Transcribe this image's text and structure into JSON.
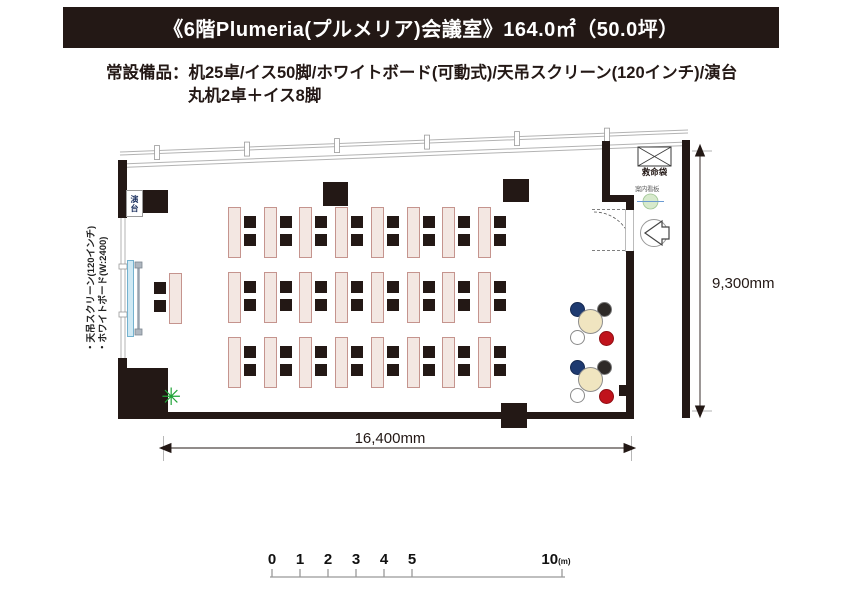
{
  "header": {
    "title": "《6階Plumeria(プルメリア)会議室》164.0㎡（50.0坪）"
  },
  "equipment": {
    "line1": "常設備品：机25卓/イス50脚/ホワイトボード(可動式)/天吊スクリーン(120インチ)/演台",
    "line2": "丸机2卓＋イス8脚"
  },
  "floorplan": {
    "labels": {
      "lectern": "演台",
      "screen_note": "・天吊スクリーン(120インチ)",
      "whiteboard_note": "・ホワイトボード(W:2400)",
      "rescue_bag": "救命袋",
      "info_sign": "案内看板"
    },
    "dimensions": {
      "width": "16,400mm",
      "height": "9,300mm"
    },
    "colors": {
      "wall": "#231815",
      "desk_fill": "#f3e7e2",
      "desk_border": "#c5948e",
      "chair": "#231815",
      "round_table": "#f0e5c0",
      "chair_navy": "#1e3a70",
      "chair_dark": "#2e2a28",
      "chair_white": "#ffffff",
      "chair_red": "#c0131c",
      "screen": "#cfe9f4",
      "plant": "#1fa337"
    },
    "furniture": {
      "desk_rows": {
        "rows_y": [
          207,
          272,
          337
        ],
        "count_per_row": 8,
        "start_x": 228,
        "spacing": 35.7,
        "desk_w": 13,
        "desk_h": 51,
        "chair_dx": 16,
        "chair_dy": [
          9,
          27
        ],
        "chair_size": 12
      },
      "head_desk": {
        "x": 169,
        "y": 273,
        "chair_x": 154,
        "chairs_y": [
          282,
          300
        ]
      },
      "round_tables": {
        "centers": [
          [
            590,
            321
          ],
          [
            590,
            379
          ]
        ],
        "table_r": 12.5,
        "chair_r": 7.5,
        "chair_offsets": {
          "navy": [
            -13,
            -12
          ],
          "dark": [
            14,
            -12
          ],
          "white": [
            -13,
            16
          ],
          "red": [
            16,
            17
          ]
        }
      },
      "pillars": [
        [
          143,
          190,
          25,
          23
        ],
        [
          323,
          182,
          25,
          24
        ],
        [
          503,
          179,
          26,
          23
        ],
        [
          501,
          403,
          26,
          25
        ]
      ],
      "walls": [
        [
          118,
          160,
          9,
          58
        ],
        [
          118,
          358,
          9,
          54
        ],
        [
          118,
          368,
          50,
          44
        ],
        [
          118,
          412,
          516,
          7
        ],
        [
          602,
          141,
          8,
          57
        ],
        [
          602,
          195,
          32,
          7
        ],
        [
          626,
          197,
          8,
          13
        ],
        [
          626,
          251,
          8,
          168
        ],
        [
          619,
          385,
          8,
          11
        ],
        [
          682,
          140,
          8,
          278
        ]
      ],
      "window_posts_x": [
        157,
        247,
        337,
        427,
        517,
        607
      ]
    }
  },
  "scalebar": {
    "unit": "(m)",
    "ticks": [
      {
        "label": "0",
        "x": 272
      },
      {
        "label": "1",
        "x": 300
      },
      {
        "label": "2",
        "x": 328
      },
      {
        "label": "3",
        "x": 356
      },
      {
        "label": "4",
        "x": 384
      },
      {
        "label": "5",
        "x": 412
      },
      {
        "label": "10",
        "x": 556
      }
    ]
  }
}
